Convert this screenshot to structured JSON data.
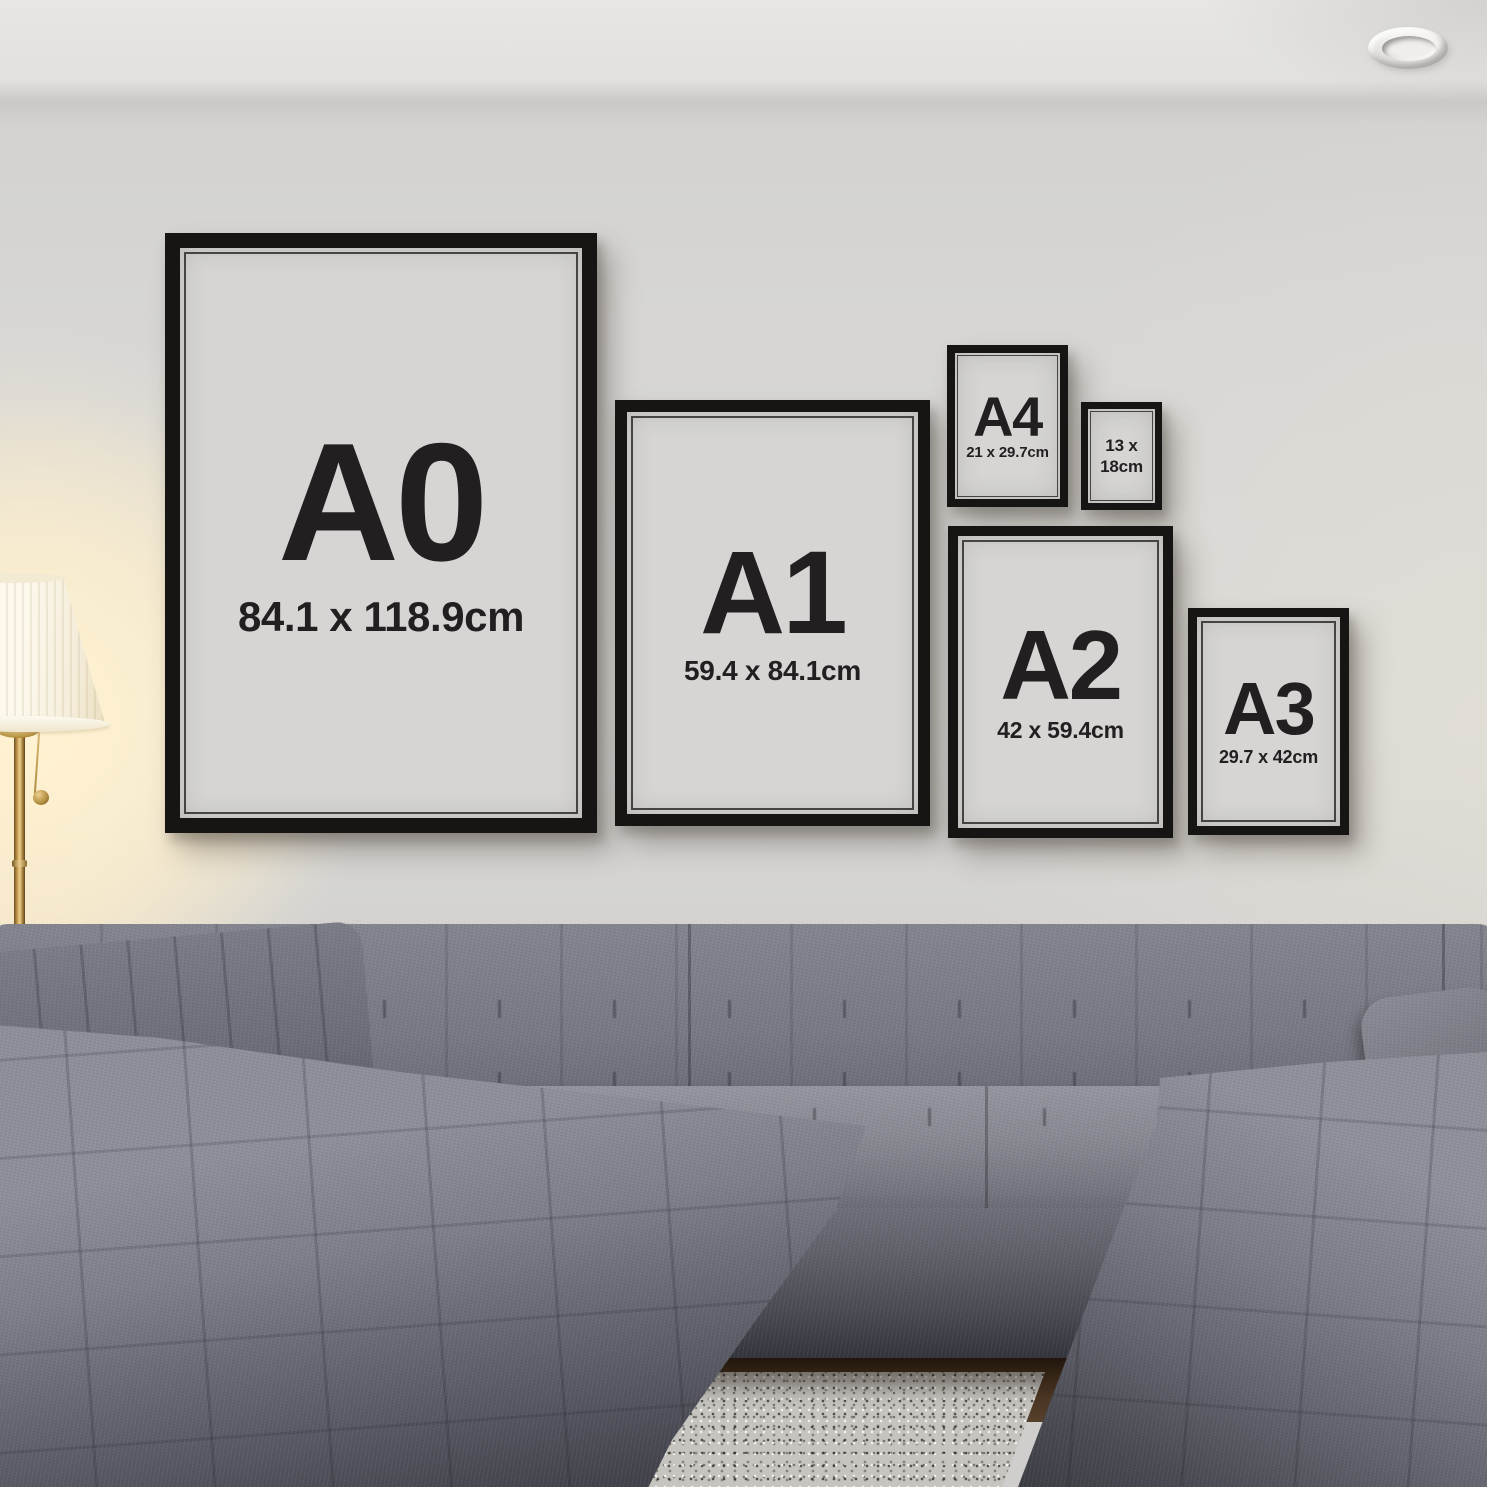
{
  "frames": [
    {
      "id": "a0",
      "label": "A0",
      "dimensions": "84.1 x 118.9cm"
    },
    {
      "id": "a1",
      "label": "A1",
      "dimensions": "59.4 x 84.1cm"
    },
    {
      "id": "a4",
      "label": "A4",
      "dimensions": "21 x 29.7cm"
    },
    {
      "id": "13x18",
      "label": "",
      "dimensions": "13 x 18cm",
      "dimension_lines": [
        "13 x",
        "18cm"
      ]
    },
    {
      "id": "a2",
      "label": "A2",
      "dimensions": "42 x 59.4cm"
    },
    {
      "id": "a3",
      "label": "A3",
      "dimensions": "29.7 x 42cm"
    }
  ],
  "colors": {
    "wall": "#d7d6d4",
    "ceiling": "#e7e6e4",
    "frame_black": "#171514",
    "frame_mat": "#d6d5d3",
    "label_text": "#231f20",
    "sofa_fabric": "#75767f",
    "rug": "#c6c4bf",
    "wood_floor": "#3a2a1c",
    "lamp_shade": "#faf5e6",
    "lamp_brass": "#c79a4e",
    "lamp_glow": "#ffeecb"
  }
}
